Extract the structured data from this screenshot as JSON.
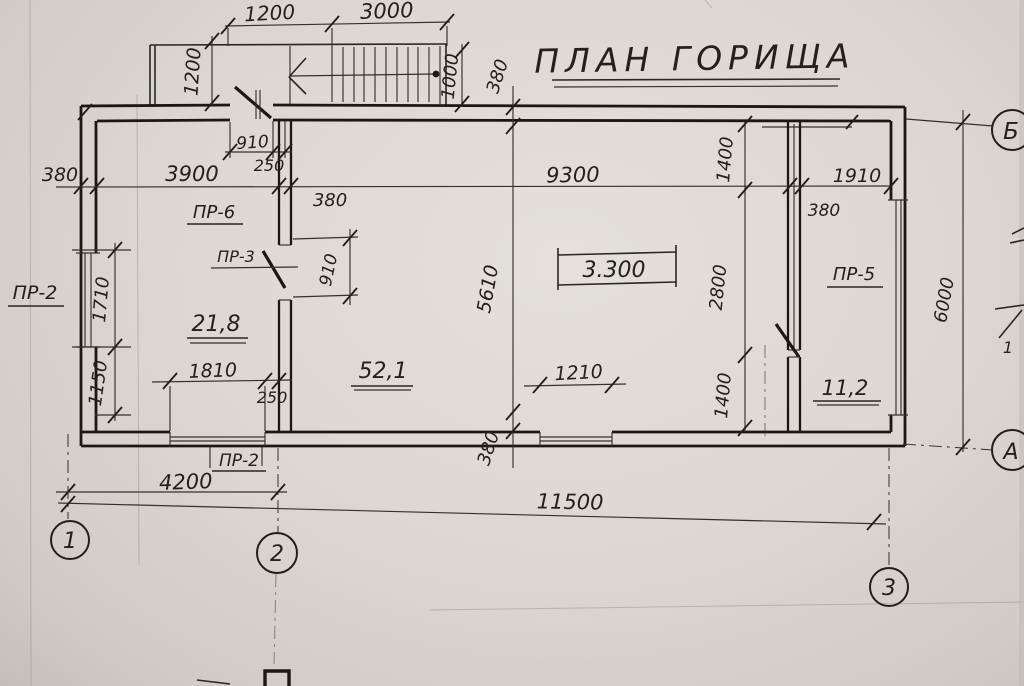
{
  "title": "ПЛАН ГОРИЩА",
  "grid_axes": {
    "col_1": "1",
    "col_2": "2",
    "col_3": "3",
    "row_a": "А",
    "row_b": "Б"
  },
  "rooms": {
    "left": "21,8",
    "main": "52,1",
    "right": "11,2"
  },
  "elevation_mark": "3.300",
  "openings": {
    "pr2_left": "ПР-2",
    "pr2_bottom": "ПР-2",
    "pr3": "ПР-3",
    "pr5": "ПР-5",
    "pr6": "ПР-6"
  },
  "section_mark": "1",
  "dims": {
    "stair_width": "1200",
    "stair_run": "3000",
    "stair_depth": "1200",
    "stair_height": "1000",
    "wall_top": "380",
    "door6_width": "910",
    "door6_pier": "250",
    "wall_left": "380",
    "room_left_width": "3900",
    "wall_mid": "380",
    "room_main_width": "9300",
    "room_right_width": "1910",
    "wall_right_duct": "380",
    "duct_offset_top": "1400",
    "window_left_top": "1710",
    "window_left_bottom": "1150",
    "door3_width": "910",
    "room_depth": "5610",
    "duct_span": "2800",
    "window_bottom_left": "1810",
    "pier_bottom": "250",
    "window_bottom_mid": "1210",
    "duct_offset_bottom": "1400",
    "wall_bottom": "380",
    "span_1_2": "4200",
    "span_total": "11500",
    "side_total": "6000"
  }
}
